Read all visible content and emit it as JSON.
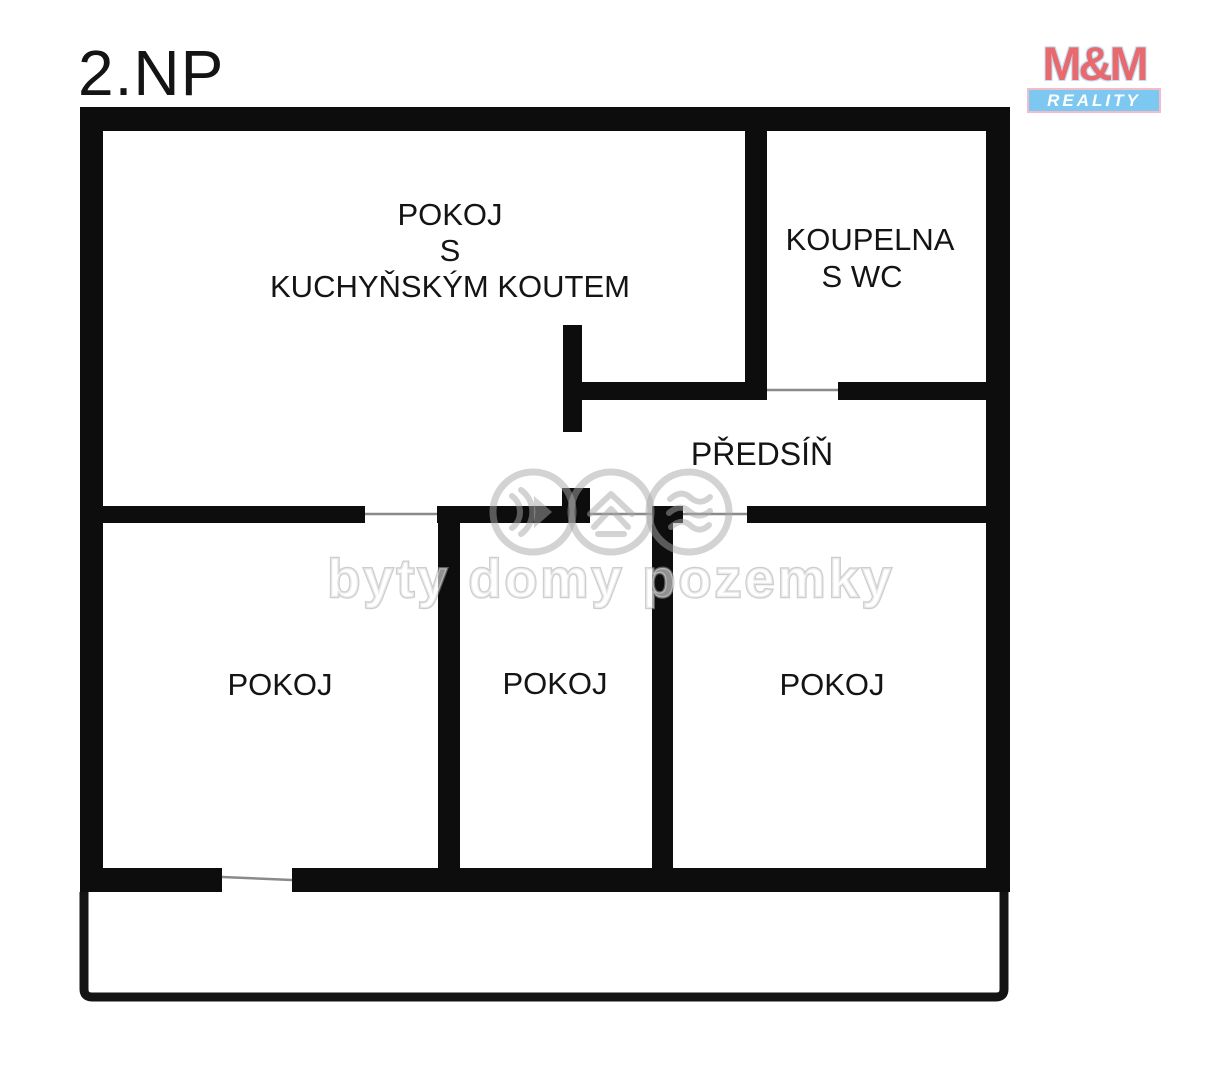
{
  "page": {
    "title": "2.NP",
    "background_color": "#ffffff",
    "wall_color": "#0d0d0d",
    "door_line_color": "#8a8a8a"
  },
  "logo": {
    "line1": "M&M",
    "line2": "REALITY",
    "colors": {
      "mm_text": "#e8696e",
      "bar_background": "#7dc8f0",
      "bar_text": "#ffffff"
    }
  },
  "rooms": {
    "living": {
      "line1": "POKOJ",
      "line2": "S",
      "line3": "KUCHYŇSKÝM KOUTEM"
    },
    "bathroom": {
      "line1": "KOUPELNA",
      "line2": "S WC"
    },
    "hallway": {
      "label": "PŘEDSÍŇ"
    },
    "bedroom_left": {
      "label": "POKOJ"
    },
    "bedroom_middle": {
      "label": "POKOJ"
    },
    "bedroom_right": {
      "label": "POKOJ"
    }
  },
  "watermark": {
    "text": "byty domy pozemky",
    "icons": [
      "sound-waves-icon",
      "house-roof-icon",
      "terrain-layers-icon"
    ],
    "color": "#a8a8a8"
  }
}
